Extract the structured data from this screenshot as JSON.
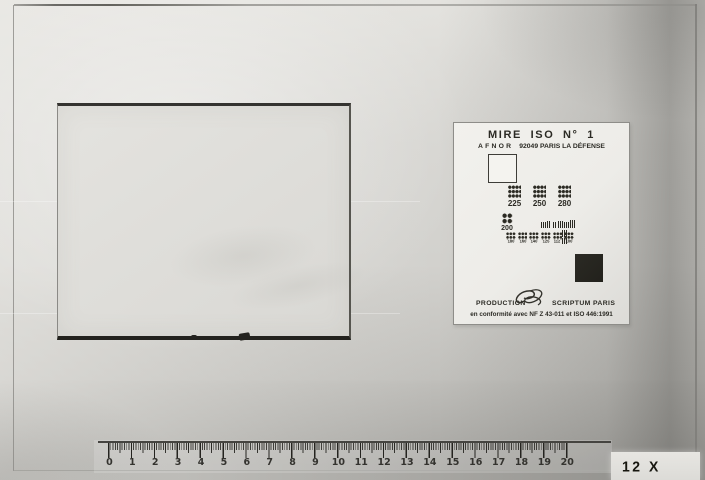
{
  "test_card": {
    "title": "MIRE ISO N° 1",
    "subtitle_brand": "AFNOR",
    "subtitle_address": "92049 PARIS LA DÉFENSE",
    "resolution_row_1": [
      {
        "label": "225"
      },
      {
        "label": "250"
      },
      {
        "label": "280"
      }
    ],
    "resolution_200_label": "200",
    "resolution_row_3": [
      {
        "label": "180"
      },
      {
        "label": "160"
      },
      {
        "label": "140"
      },
      {
        "label": "125"
      },
      {
        "label": "112"
      },
      {
        "label": "100"
      }
    ],
    "production_label": "PRODUCTION",
    "producer": "SCRIPTUM PARIS",
    "conformity": "en conformité avec NF Z 43-011 et ISO 446:1991"
  },
  "ruler": {
    "numbers": [
      "0",
      "1",
      "2",
      "3",
      "4",
      "5",
      "6",
      "7",
      "8",
      "9",
      "10",
      "11",
      "12",
      "13",
      "14",
      "15",
      "16",
      "17",
      "18",
      "19",
      "20"
    ]
  },
  "magnification": {
    "label": "12 X"
  },
  "colors": {
    "photo_background": "#d2d1cd",
    "card_background": "#f0efeb",
    "ink": "#2b2a24",
    "black_patch": "#26251f",
    "frame_line": "#8b8a86"
  }
}
